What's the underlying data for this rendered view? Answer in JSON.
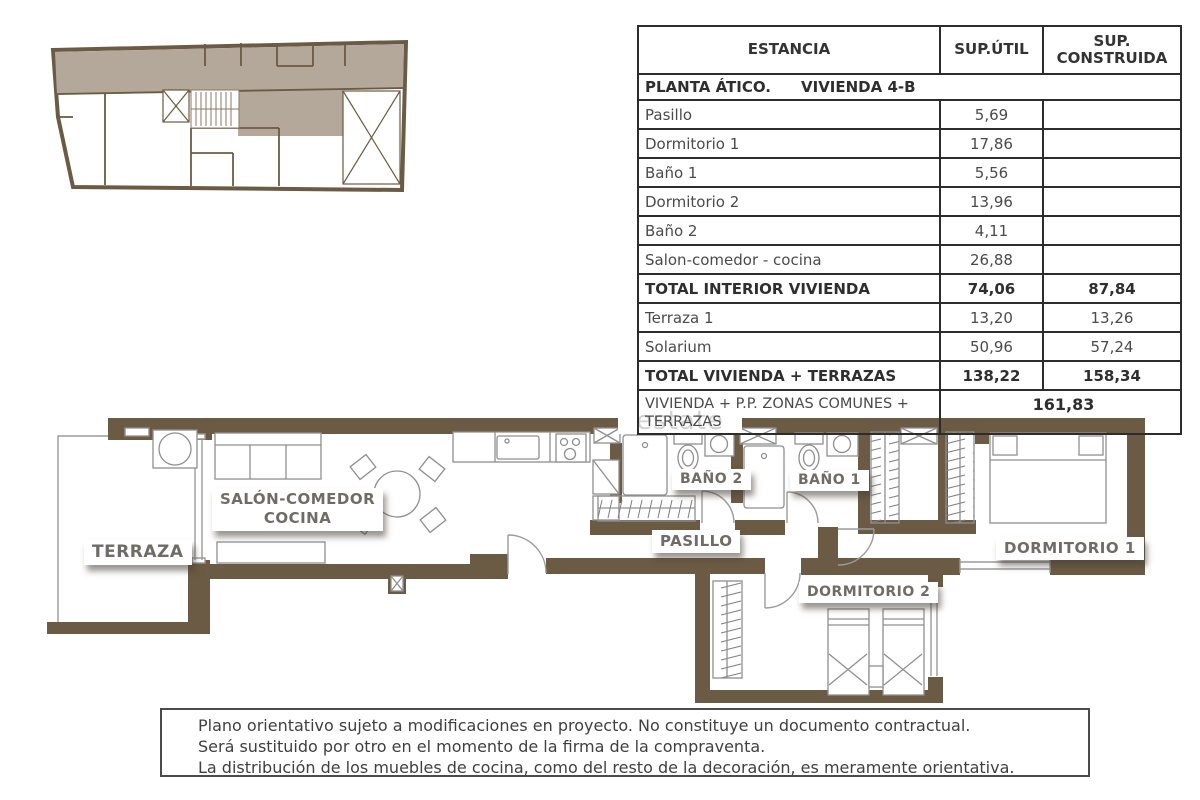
{
  "colors": {
    "wall_brown": "#6b5b44",
    "keyplan_shade": "#b3a89a",
    "label_text": "#6f6b66",
    "table_border": "#2c2c2c",
    "watermark_gray": "#d2d2d2"
  },
  "table": {
    "headers": {
      "estancia": "ESTANCIA",
      "sup_util": "SUP.ÚTIL",
      "sup_construida_line1": "SUP.",
      "sup_construida_line2": "CONSTRUIDA"
    },
    "section": {
      "left": "PLANTA ÁTICO.",
      "right": "VIVIENDA 4-B"
    },
    "rows": [
      {
        "estancia": "Pasillo",
        "util": "5,69",
        "construida": ""
      },
      {
        "estancia": "Dormitorio 1",
        "util": "17,86",
        "construida": ""
      },
      {
        "estancia": "Baño 1",
        "util": "5,56",
        "construida": ""
      },
      {
        "estancia": "Dormitorio 2",
        "util": "13,96",
        "construida": ""
      },
      {
        "estancia": "Baño 2",
        "util": "4,11",
        "construida": ""
      },
      {
        "estancia": "Salon-comedor - cocina",
        "util": "26,88",
        "construida": ""
      },
      {
        "estancia": "TOTAL INTERIOR VIVIENDA",
        "util": "74,06",
        "construida": "87,84"
      },
      {
        "estancia": "Terraza 1",
        "util": "13,20",
        "construida": "13,26"
      },
      {
        "estancia": "Solarium",
        "util": "50,96",
        "construida": "57,24"
      },
      {
        "estancia": "TOTAL VIVIENDA + TERRAZAS",
        "util": "138,22",
        "construida": "158,34"
      }
    ],
    "footer": {
      "label": "VIVIENDA + P.P. ZONAS COMUNES + TERRAZAS",
      "value": "161,83"
    }
  },
  "plan": {
    "labels": {
      "terraza": "TERRAZA",
      "salon_line1": "SALÓN-COMEDOR",
      "salon_line2": "COCINA",
      "bano2": "BAÑO 2",
      "bano1": "BAÑO 1",
      "pasillo": "PASILLO",
      "dorm1": "DORMITORIO 1",
      "dorm2": "DORMITORIO 2"
    },
    "watermark": "estate"
  },
  "disclaimer": {
    "lines": [
      "Plano orientativo sujeto a modificaciones en proyecto. No constituye un documento contractual.",
      "Será sustituido por otro en el momento de la firma de la compraventa.",
      "La distribución de los muebles de cocina, como del resto de la decoración, es meramente orientativa."
    ]
  }
}
